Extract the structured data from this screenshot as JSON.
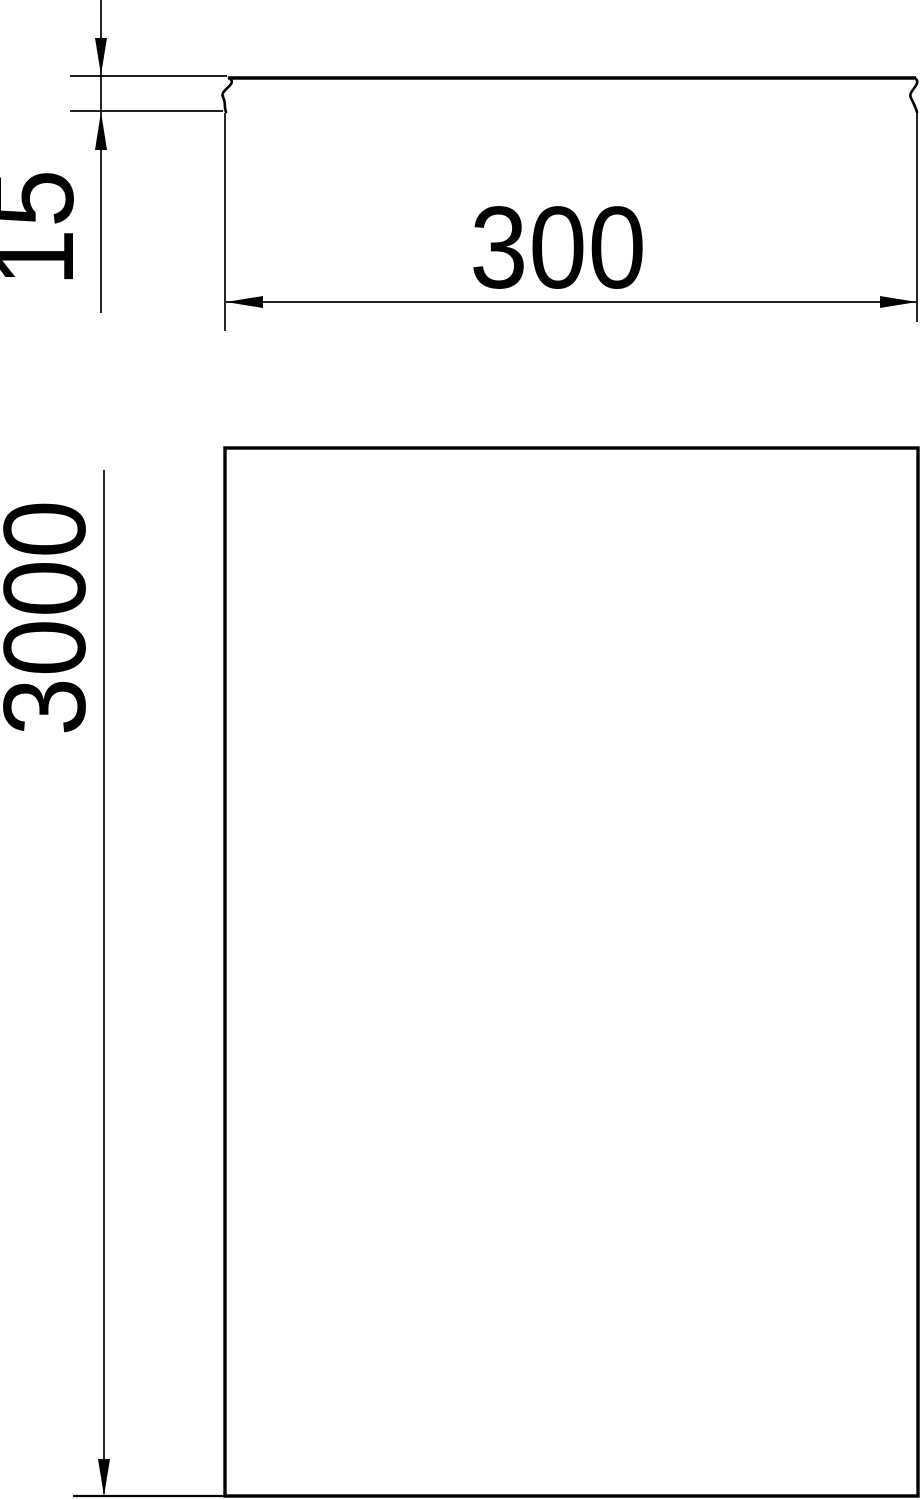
{
  "colors": {
    "ink": "#000000",
    "background": "#ffffff"
  },
  "dimensions": {
    "height_label": "15",
    "width_label": "300",
    "length_label": "3000"
  }
}
